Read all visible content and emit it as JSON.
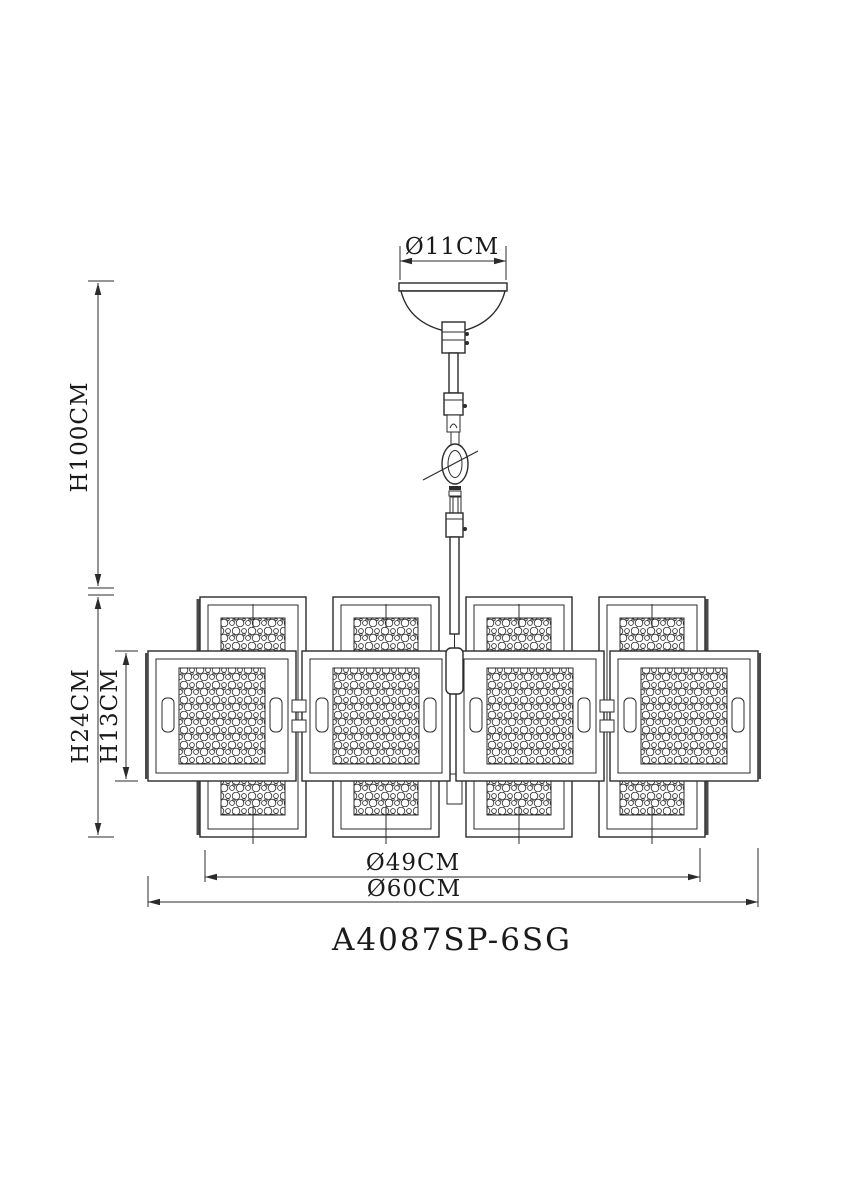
{
  "page": {
    "background": "#ffffff",
    "line_color": "#2b2b2b"
  },
  "drawing": {
    "model_number": "A4087SP-6SG",
    "dimensions": {
      "canopy_diameter": "Ø11CM",
      "suspension_height": "H100CM",
      "body_height": "H24CM",
      "panel_height": "H13CM",
      "inner_diameter": "Ø49CM",
      "overall_diameter": "Ø60CM"
    }
  }
}
